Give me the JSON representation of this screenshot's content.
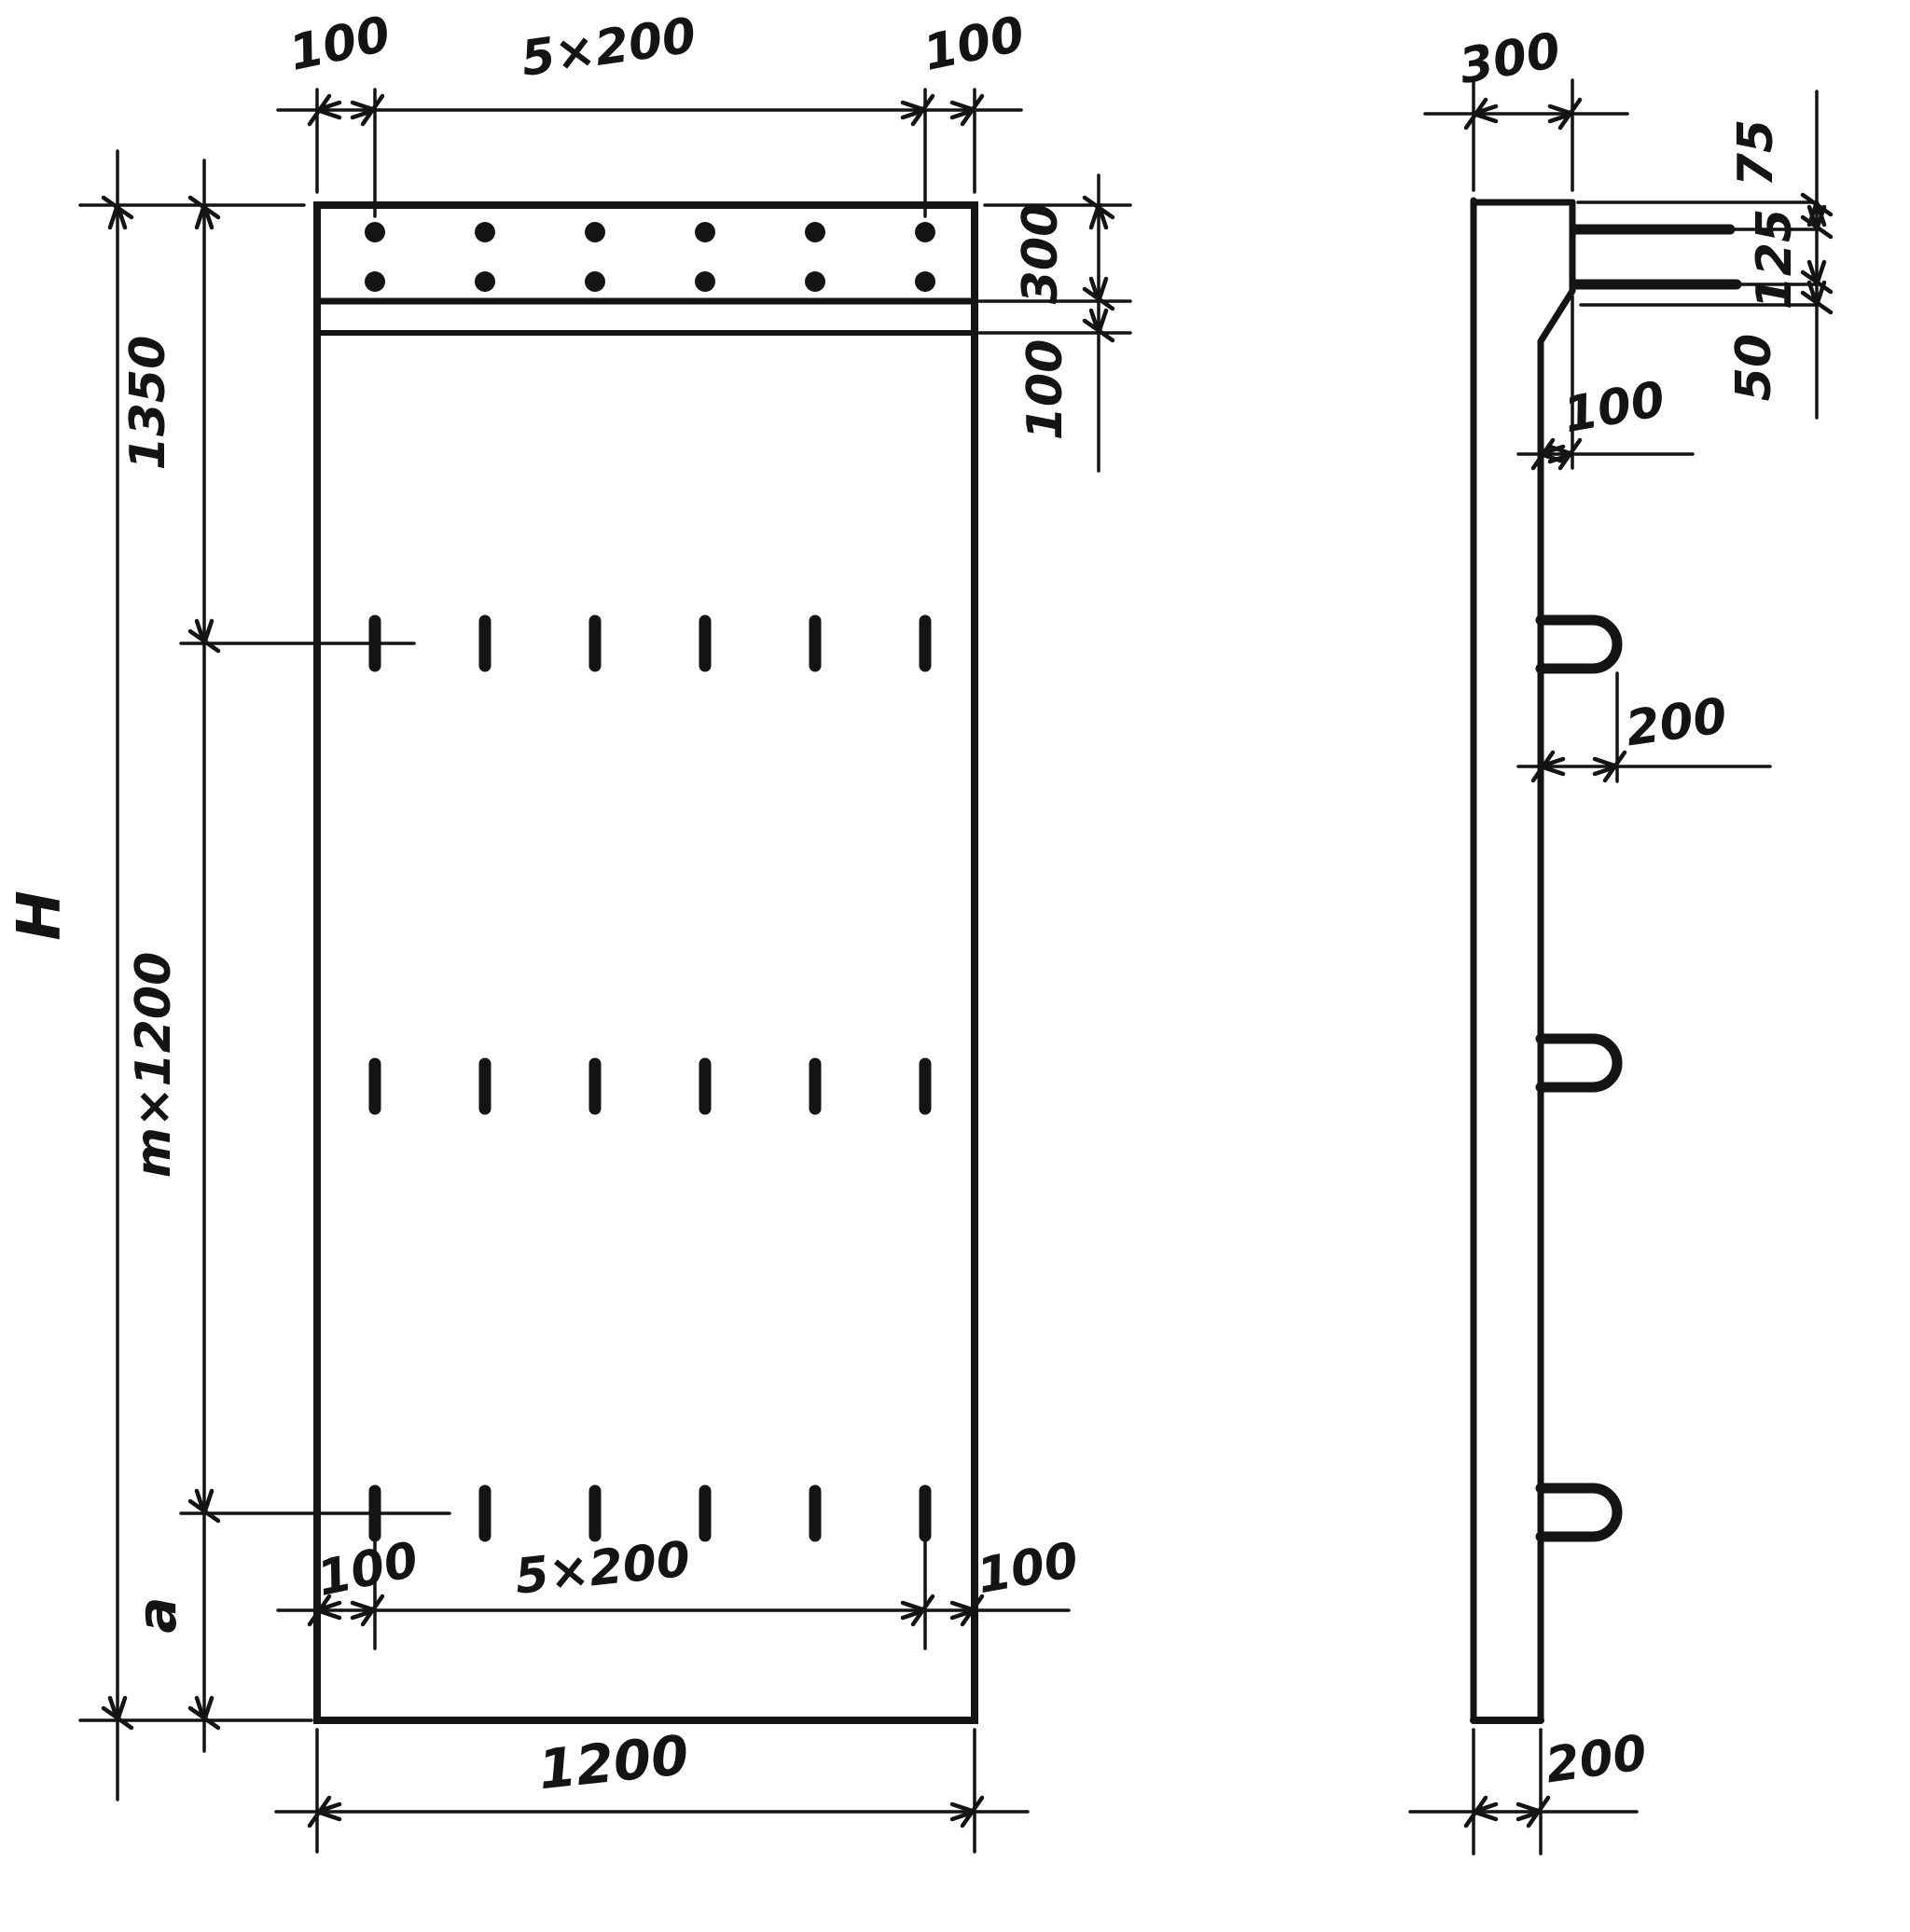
{
  "drawing": {
    "type": "technical-drawing",
    "ink_color": "#141414",
    "paper_color": "#ffffff",
    "front_view": {
      "top_dims": {
        "left": "100",
        "middle": "5×200",
        "right": "100"
      },
      "right_dims": {
        "head_height": "300",
        "strip_height": "100"
      },
      "left_dims": {
        "total_height": "H",
        "upper": "1350",
        "middle": "m×1200",
        "lower": "a"
      },
      "bottom_dims": {
        "left": "100",
        "middle": "5×200",
        "right": "100",
        "overall_width": "1200"
      },
      "features": {
        "dot_rows": 2,
        "dots_per_row": 6,
        "slot_rows": 3,
        "slots_per_row": 6
      }
    },
    "side_view": {
      "top_width": "300",
      "bar_dims": {
        "top_offset": "75",
        "spacing": "125",
        "bottom_offset": "50"
      },
      "step_depth": "100",
      "loop_length": "200",
      "panel_thickness": "200",
      "features": {
        "protruding_bars": 2,
        "lifting_loops": 3
      }
    }
  }
}
